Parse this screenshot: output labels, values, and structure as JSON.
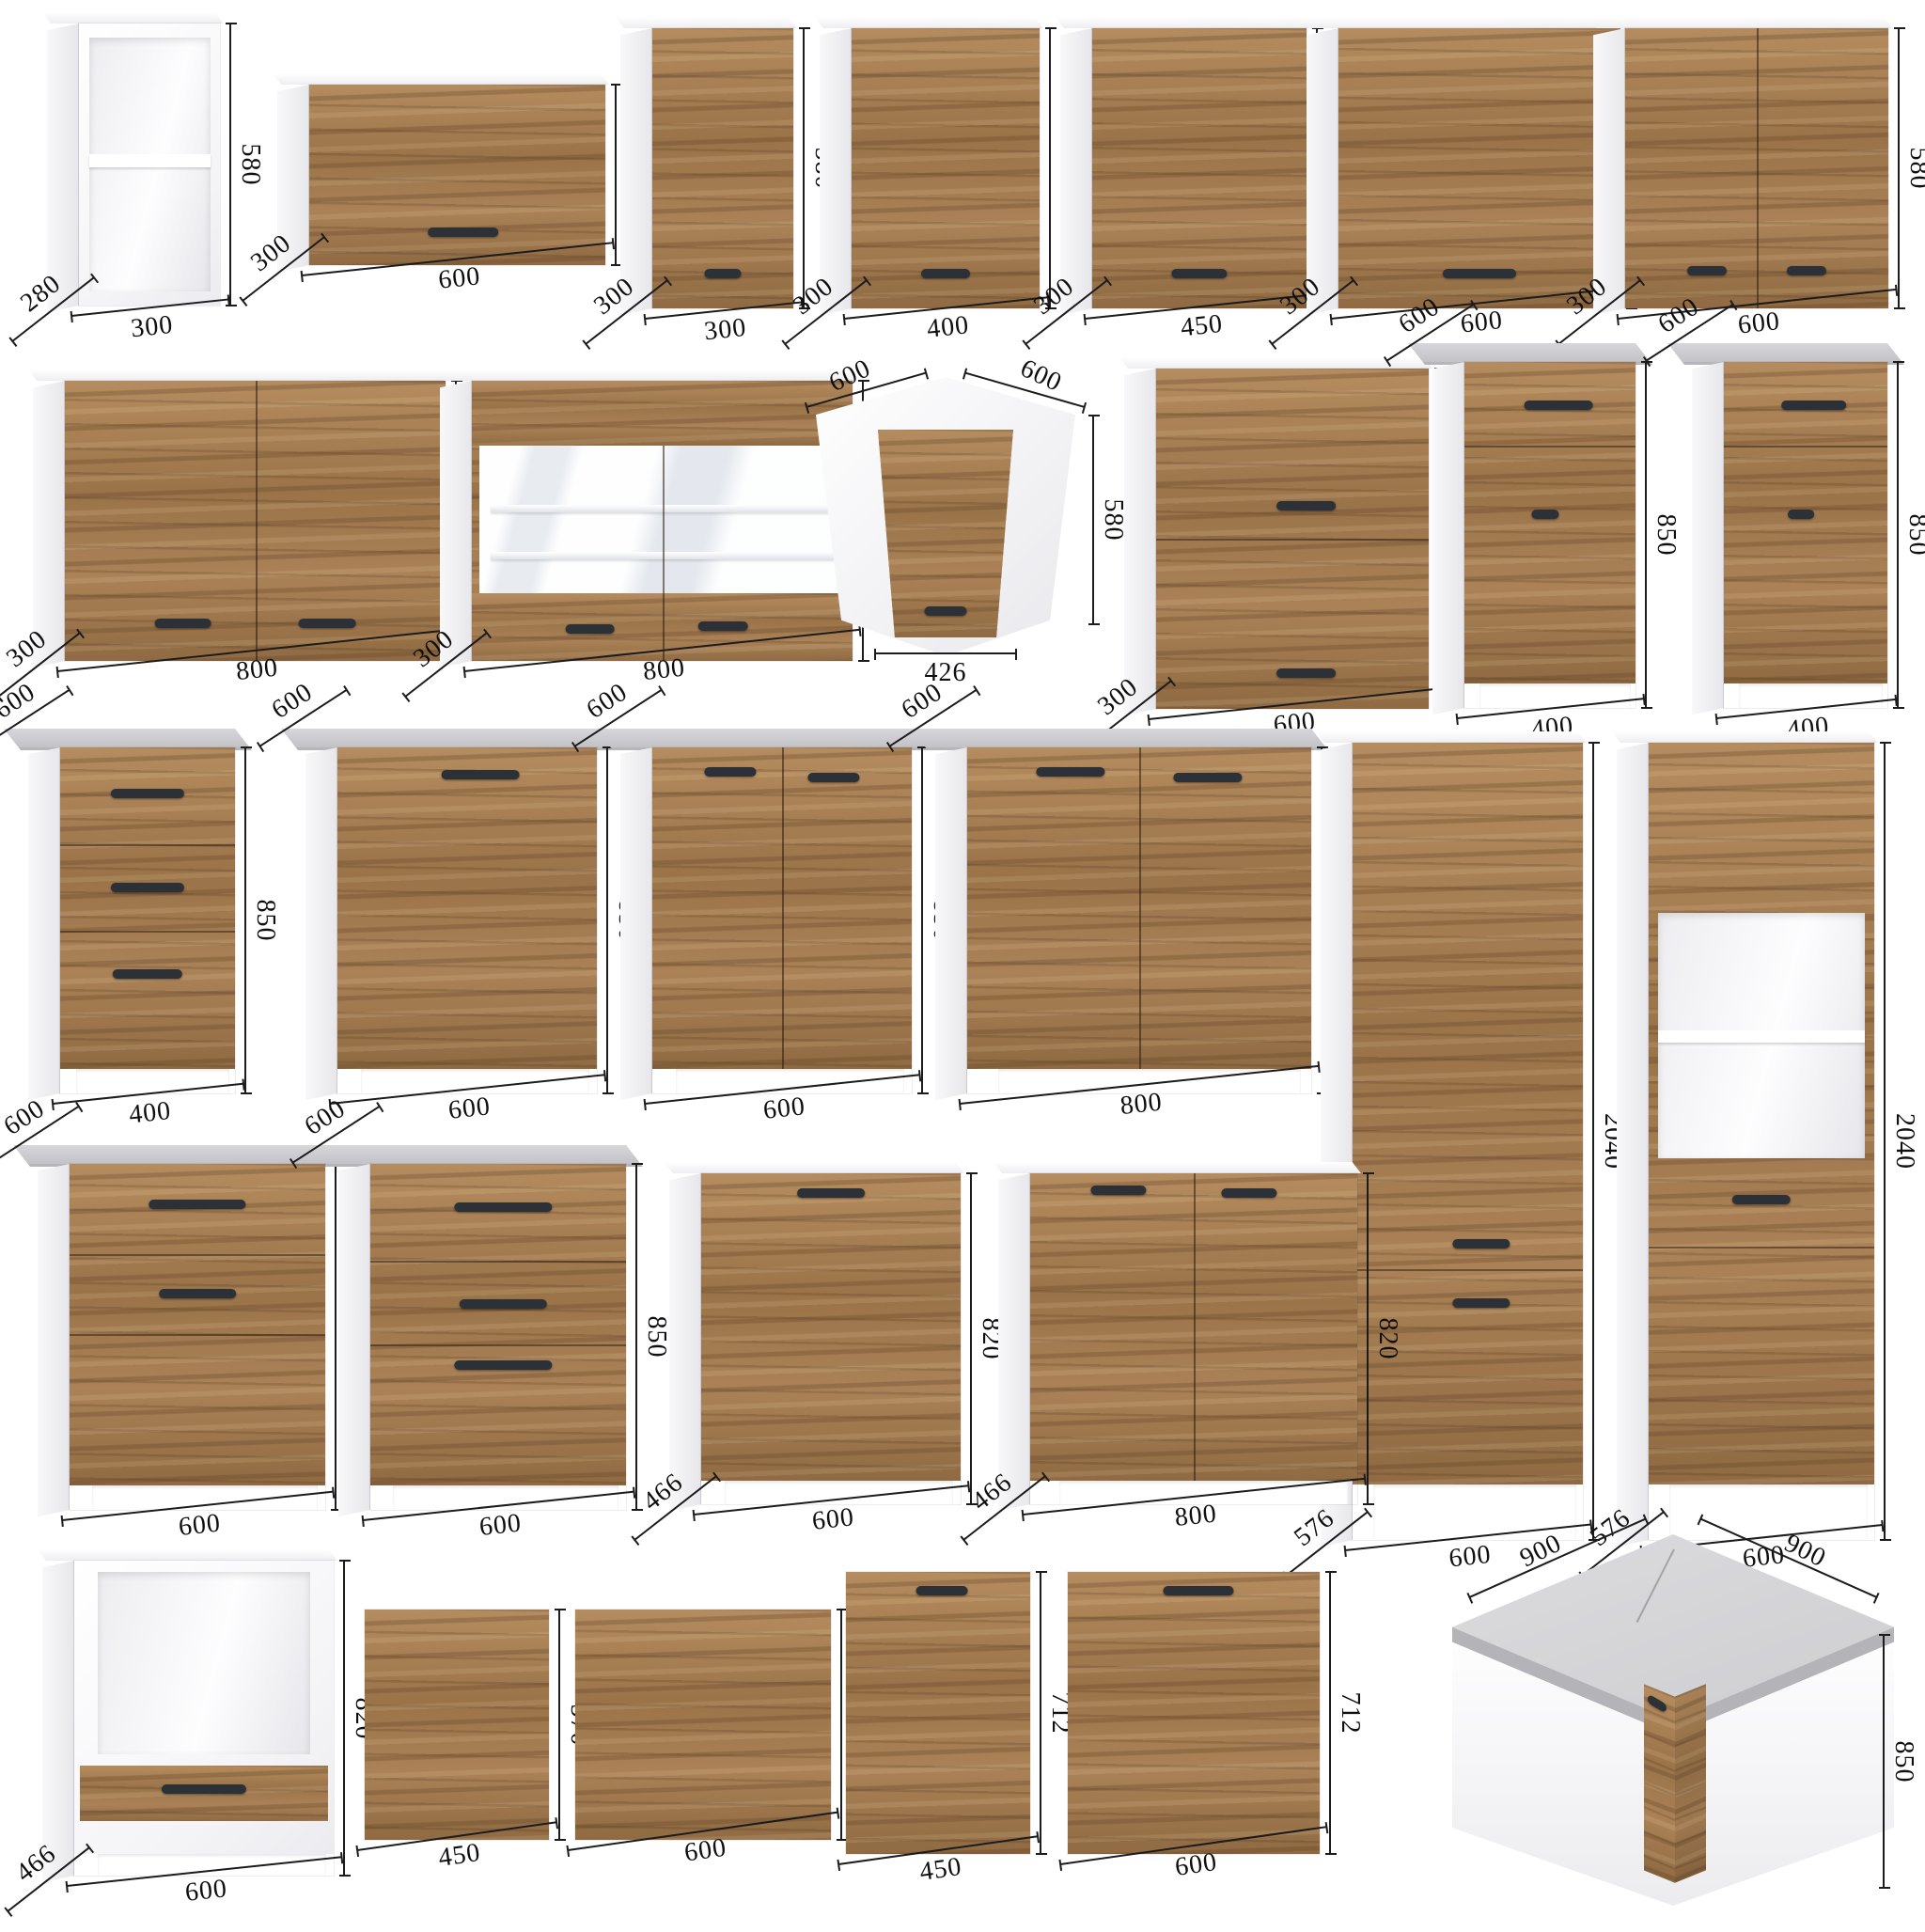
{
  "palette": {
    "wood": "#a47c52",
    "wood_dark": "#6e4f31",
    "carcass_white": "#ffffff",
    "carcass_shade": "#ececf0",
    "worktop_gray": "#c9c9cd",
    "handle_dark": "#2c3137",
    "dimension_line": "#1c1c1c"
  },
  "units": "mm",
  "items": [
    {
      "id": "r1c1",
      "kind": "open-wall",
      "w": "300",
      "h": "580",
      "d": "280"
    },
    {
      "id": "r1c2",
      "kind": "wall-flap",
      "w": "600",
      "h": "360",
      "d": "300"
    },
    {
      "id": "r1c3",
      "kind": "wall-door",
      "w": "300",
      "h": "580",
      "d": "300"
    },
    {
      "id": "r1c4",
      "kind": "wall-door",
      "w": "400",
      "h": "580",
      "d": "300"
    },
    {
      "id": "r1c5",
      "kind": "wall-door",
      "w": "450",
      "h": "580",
      "d": "300"
    },
    {
      "id": "r1c6",
      "kind": "wall-door",
      "w": "600",
      "h": "580",
      "d": "300"
    },
    {
      "id": "r1c7",
      "kind": "wall-2door",
      "w": "600",
      "h": "580",
      "d": "300"
    },
    {
      "id": "r2c1",
      "kind": "wall-2door",
      "w": "800",
      "h": "580",
      "d": "300"
    },
    {
      "id": "r2c2",
      "kind": "wall-glass",
      "w": "800",
      "h": "580",
      "d": "300"
    },
    {
      "id": "r2c3",
      "kind": "wall-corner",
      "top": [
        "600",
        "600"
      ],
      "front": "426",
      "h": "580"
    },
    {
      "id": "r2c4",
      "kind": "wall-2flap",
      "w": "600",
      "h": "720",
      "d": "300"
    },
    {
      "id": "r2c5",
      "kind": "base-drawer-door",
      "w": "400",
      "h": "850",
      "d": "600"
    },
    {
      "id": "r2c6",
      "kind": "base-drawer-door",
      "w": "400",
      "h": "850",
      "d": "600"
    },
    {
      "id": "r3c1",
      "kind": "base-3drawer",
      "w": "400",
      "h": "850",
      "d": "600"
    },
    {
      "id": "r3c2",
      "kind": "base-door",
      "w": "600",
      "h": "850",
      "d": "600"
    },
    {
      "id": "r3c3",
      "kind": "base-2door",
      "w": "600",
      "h": "850",
      "d": "600"
    },
    {
      "id": "r3c4",
      "kind": "base-2door",
      "w": "800",
      "h": "850",
      "d": "600"
    },
    {
      "id": "r3c5",
      "kind": "tall-2door",
      "w": "600",
      "h": "2040",
      "d": "576"
    },
    {
      "id": "r3c6",
      "kind": "tall-oven",
      "w": "600",
      "h": "2040",
      "d": "576"
    },
    {
      "id": "r4c1",
      "kind": "base-2drawer-door",
      "w": "600",
      "h": "850",
      "d": "600"
    },
    {
      "id": "r4c2",
      "kind": "base-3drawer-deep",
      "w": "600",
      "h": "850",
      "d": "600"
    },
    {
      "id": "r4c3",
      "kind": "appl-door",
      "w": "600",
      "h": "820",
      "d": "466"
    },
    {
      "id": "r4c4",
      "kind": "appl-2door",
      "w": "800",
      "h": "820",
      "d": "466"
    },
    {
      "id": "r5c1",
      "kind": "oven-housing",
      "w": "600",
      "h": "820",
      "d": "466"
    },
    {
      "id": "r5c2",
      "kind": "front-panel",
      "w": "450",
      "h": "570"
    },
    {
      "id": "r5c3",
      "kind": "front-panel",
      "w": "600",
      "h": "570"
    },
    {
      "id": "r5c4",
      "kind": "front-panel-handle",
      "w": "450",
      "h": "712"
    },
    {
      "id": "r5c5",
      "kind": "front-panel-handle",
      "w": "600",
      "h": "712"
    },
    {
      "id": "r5c6",
      "kind": "base-corner",
      "top": [
        "900",
        "900"
      ],
      "h": "850"
    }
  ]
}
